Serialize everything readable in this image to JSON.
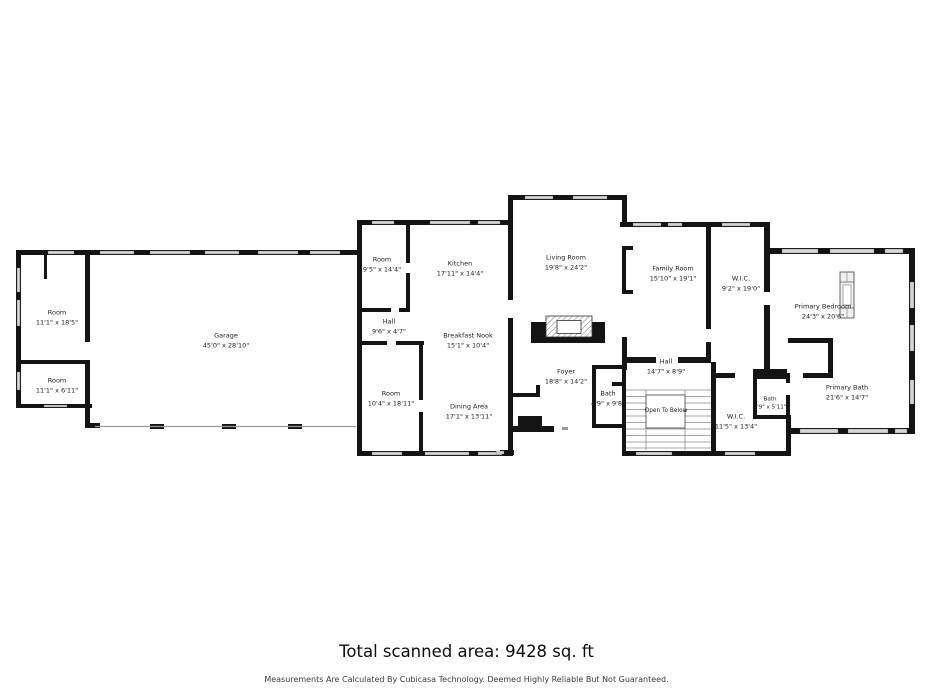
{
  "footer": {
    "total_area": "Total scanned area: 9428 sq. ft",
    "disclaimer": "Measurements Are Calculated By Cubicasa Technology. Deemed Highly Reliable But Not Guaranteed."
  },
  "colors": {
    "wall": "#141414",
    "window": "#d6d6d6",
    "text": "#1c1c1c"
  },
  "stairs": {
    "label": "Open To Below"
  },
  "rooms": [
    {
      "name": "Room",
      "dims": "11'1\" x 18'5\""
    },
    {
      "name": "Room",
      "dims": "11'1\" x 6'11\""
    },
    {
      "name": "Garage",
      "dims": "45'0\" x 28'10\""
    },
    {
      "name": "Room",
      "dims": "9'5\" x 14'4\""
    },
    {
      "name": "Kitchen",
      "dims": "17'11\" x 14'4\""
    },
    {
      "name": "Hall",
      "dims": "9'6\" x 4'7\""
    },
    {
      "name": "Breakfast Nook",
      "dims": "15'1\" x 10'4\""
    },
    {
      "name": "Room",
      "dims": "10'4\" x 18'11\""
    },
    {
      "name": "Dining Area",
      "dims": "17'1\" x 13'11\""
    },
    {
      "name": "Living Room",
      "dims": "19'8\" x 24'2\""
    },
    {
      "name": "Foyer",
      "dims": "18'8\" x 14'2\""
    },
    {
      "name": "Family Room",
      "dims": "15'10\" x 19'1\""
    },
    {
      "name": "W.I.C.",
      "dims": "9'2\" x 19'0\""
    },
    {
      "name": "Hall",
      "dims": "14'7\" x 8'9\""
    },
    {
      "name": "Bath",
      "dims": "4'9\" x 9'8\""
    },
    {
      "name": "W.I.C.",
      "dims": "11'5\" x 13'4\""
    },
    {
      "name": "Bath",
      "dims": "4'9\" x 5'11\""
    },
    {
      "name": "Primary Bedroom",
      "dims": "24'3\" x 20'6\""
    },
    {
      "name": "Primary Bath",
      "dims": "21'6\" x 14'7\""
    }
  ]
}
